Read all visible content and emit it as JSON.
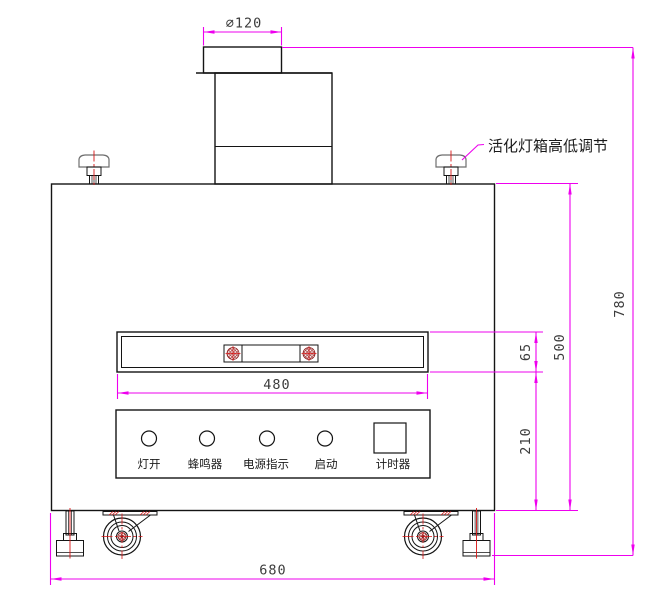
{
  "drawing": {
    "kind": "equipment-front-elevation",
    "annotation": {
      "lamp_box_note": "活化灯箱高低调节"
    },
    "dims": {
      "pipe_dia": "∅120",
      "overall_height": "780",
      "upper_height": "500",
      "slot_height": "65",
      "lower_height": "210",
      "slot_width": "480",
      "overall_width": "680"
    },
    "panel": {
      "controls": [
        {
          "type": "indicator",
          "label": "灯开"
        },
        {
          "type": "indicator",
          "label": "蜂鸣器"
        },
        {
          "type": "indicator",
          "label": "电源指示"
        },
        {
          "type": "indicator",
          "label": "启动"
        },
        {
          "type": "display",
          "label": "计时器"
        }
      ]
    },
    "colors": {
      "dimension_line": "#ee00ee",
      "centerline": "#d81414",
      "geometry": "#141414"
    }
  }
}
